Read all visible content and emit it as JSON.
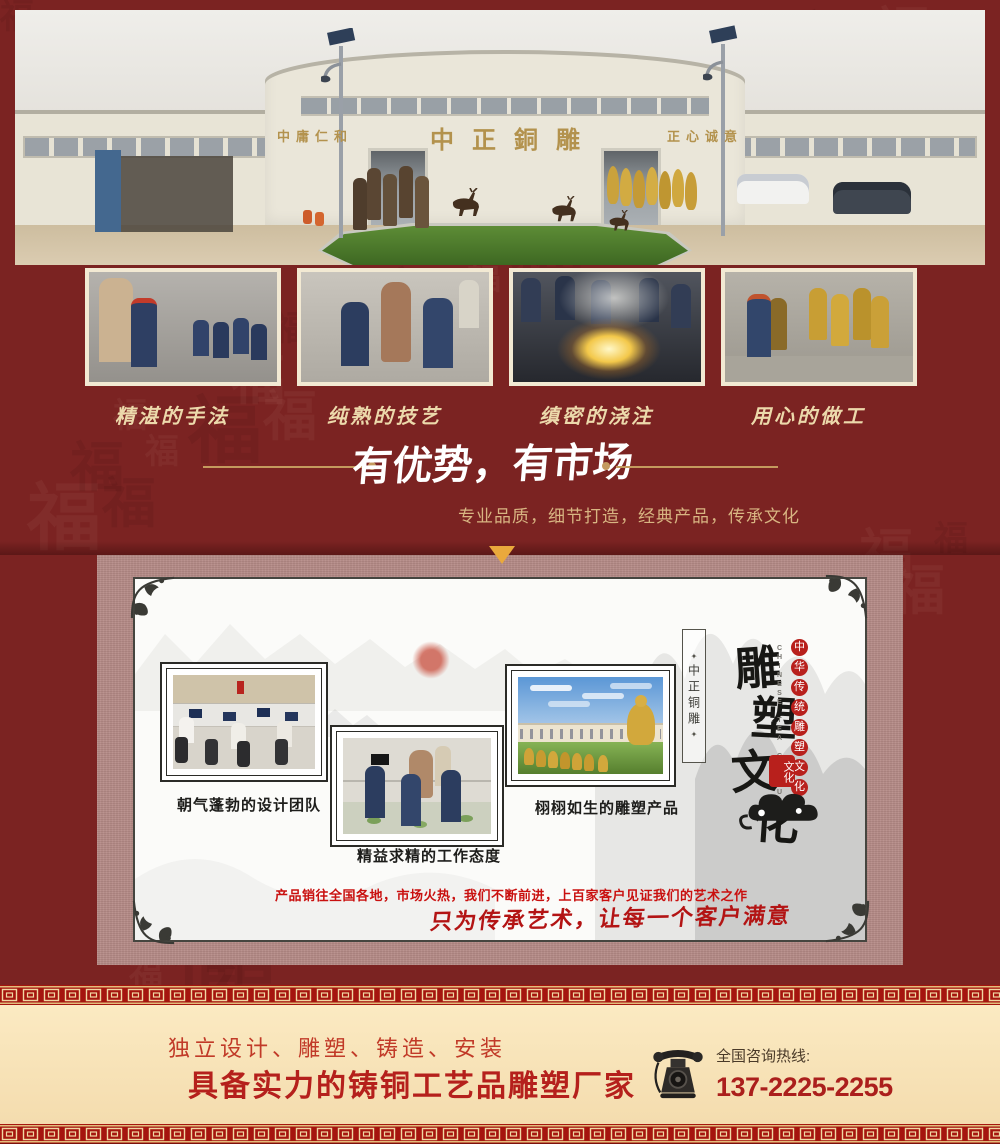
{
  "hero": {
    "sign_left": "中庸仁和",
    "sign_center": "中正銅雕",
    "sign_right": "正心诚意"
  },
  "process": {
    "items": [
      {
        "caption": "精湛的手法"
      },
      {
        "caption": "纯熟的技艺"
      },
      {
        "caption": "缜密的浇注"
      },
      {
        "caption": "用心的做工"
      }
    ]
  },
  "advantage": {
    "title": "有优势，有市场",
    "subtitle": "专业品质，细节打造，经典产品，传承文化"
  },
  "culture": {
    "photo_captions": [
      "朝气蓬勃的设计团队",
      "精益求精的工作态度",
      "栩栩如生的雕塑产品"
    ],
    "side_seal_text": "中正铜雕",
    "title_chars": [
      "雕",
      "塑",
      "文",
      "化"
    ],
    "subtitle_chars": [
      "中",
      "华",
      "传",
      "统",
      "雕",
      "塑",
      "文",
      "化"
    ],
    "subtitle_en": "CHINESE TEA CULTURE",
    "stamp_text": "文化",
    "marketing": "产品销往全国各地，市场火热，我们不断前进，上百家客户见证我们的艺术之作",
    "slogan": "只为传承艺术，让每一个客户满意"
  },
  "footer": {
    "services": "独立设计、雕塑、铸造、安装",
    "headline": "具备实力的铸铜工艺品雕塑厂家",
    "hotline_label": "全国咨询热线:",
    "phone": "137-2225-2255"
  },
  "decor": {
    "background_glyph": "福",
    "colors": {
      "page_bg": "#7b2322",
      "card_bg": "#b58a86",
      "gold": "#c49a5e",
      "accent_red": "#b5201c",
      "cream": "#f7e3b7"
    }
  }
}
